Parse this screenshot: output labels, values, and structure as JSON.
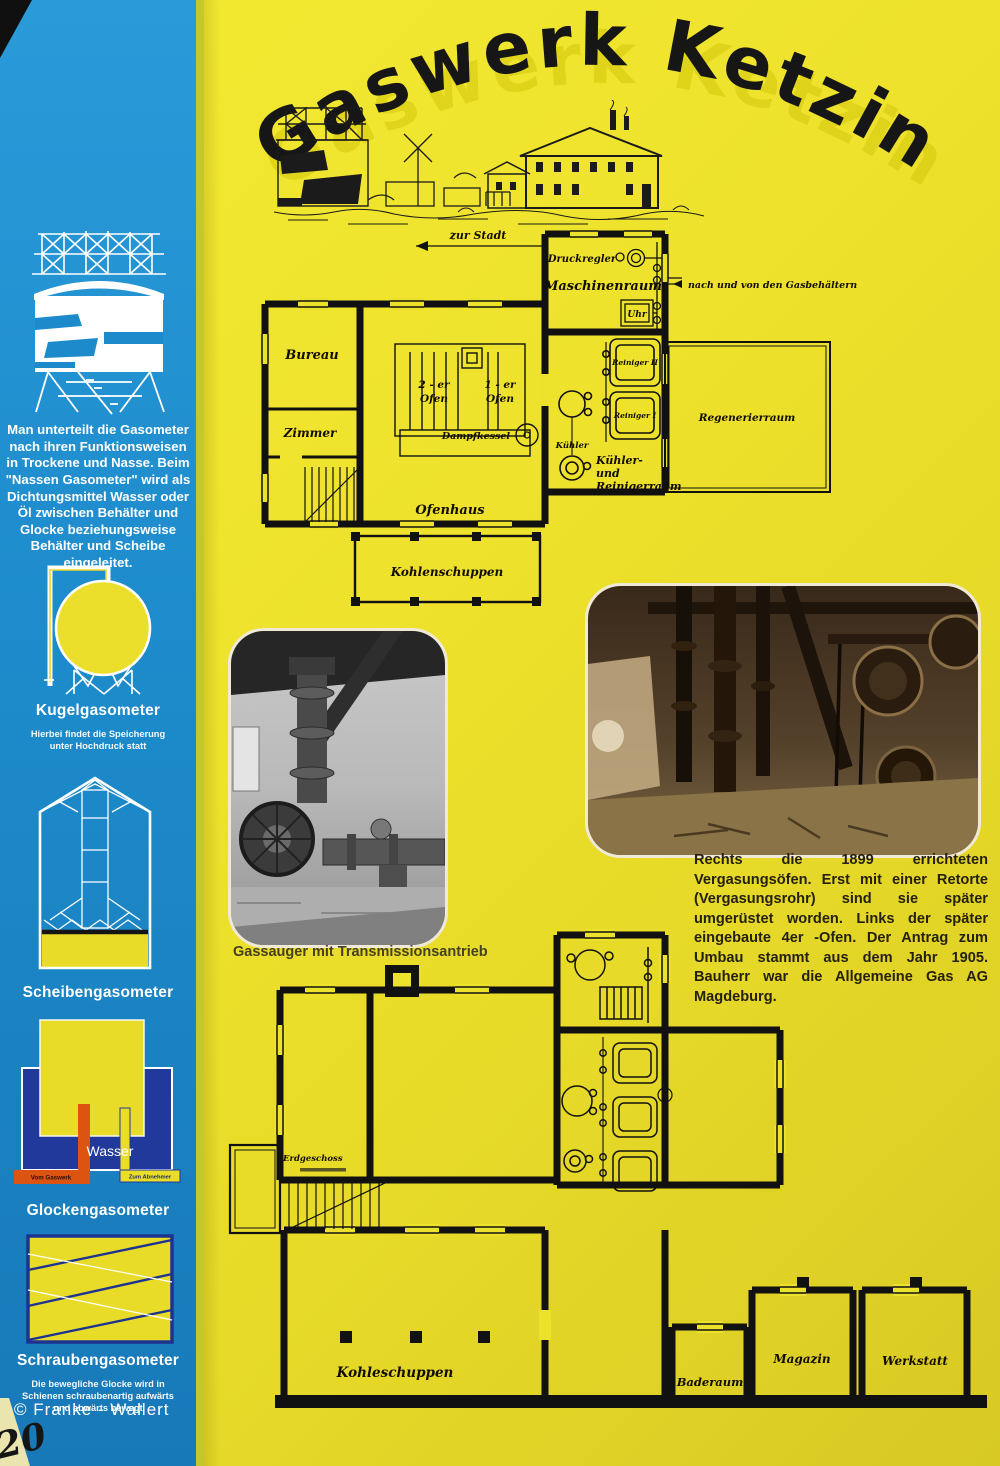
{
  "title": {
    "text": "Gaswerk Ketzin"
  },
  "sidebar": {
    "intro": "Man unterteilt die Gasometer nach ihren Funktionsweisen in Trockene und Nasse. Beim \"Nassen Gasometer\" wird als Dichtungsmittel Wasser oder Öl zwischen Behälter und Glocke beziehungsweise Behälter und Scheibe eingeleitet.",
    "kugel_label": "Kugelgasometer",
    "kugel_caption": "Hierbei findet die Speicherung unter Hochdruck statt",
    "scheiben_label": "Scheibengasometer",
    "glocken_label": "Glockengasometer",
    "glocken_wasser": "Wasser",
    "glocken_inlet": "Vom Gaswerk",
    "glocken_outlet": "Zum Abnehmer",
    "schrauben_label": "Schraubengasometer",
    "schrauben_caption": "Die bewegliche Glocke wird in Schienen schraubenartig aufwärts und abwärts bewegt",
    "credit": "©   Franke - Wallert"
  },
  "plan_top": {
    "labels": {
      "zur_stadt": "zur Stadt",
      "gasbehaelter": "nach und von den Gasbehältern",
      "druckregler": "Druckregler",
      "maschinenraum": "Maschinenraum",
      "uhr": "Uhr",
      "reiniger2": "Reiniger II",
      "reiniger1": "Reiniger I",
      "regenerierraum": "Regenerierraum",
      "kuehler": "Kühler",
      "kuehlerraum1": "Kühler-",
      "kuehlerraum2": "und",
      "kuehlerraum3": "Reinigerraum",
      "bureau": "Bureau",
      "zimmer": "Zimmer",
      "ofen2": "2 - er",
      "ofen2word": "Ofen",
      "ofen1": "1 - er",
      "ofen1word": "Ofen",
      "ofenhaus": "Ofenhaus",
      "dampfkessel": "Dampfkessel",
      "kohlenschuppen": "Kohlenschuppen"
    }
  },
  "photo_left": {
    "caption": "Gassauger mit Transmissionsantrieb"
  },
  "article": {
    "text": "Rechts die 1899 errichteten Vergasungsöfen. Erst mit einer Retorte (Vergasungsrohr) sind sie später umgerüstet worden. Links der später eingebaute 4er -Ofen. Der Antrag zum Umbau stammt aus dem Jahr 1905. Bauherr war die Allgemeine Gas AG Magdeburg.",
    "photo_right_subject": "Vergasungsöfen von 1899"
  },
  "plan_bottom": {
    "labels": {
      "erdgeschoss": "Erdgeschoss",
      "kohleschuppen": "Kohleschuppen",
      "baderaum": "Baderaum",
      "magazin": "Magazin",
      "werkstatt": "Werkstatt"
    }
  },
  "page": {
    "handwritten_number": "20"
  },
  "colors": {
    "sidebar_blue": "#1d8bcb",
    "poster_yellow": "#ece22c",
    "tank_navy": "#20399b",
    "pipe_orange": "#dd5310",
    "pipe_yellow": "#eadd2a",
    "ink_black": "#141414"
  }
}
